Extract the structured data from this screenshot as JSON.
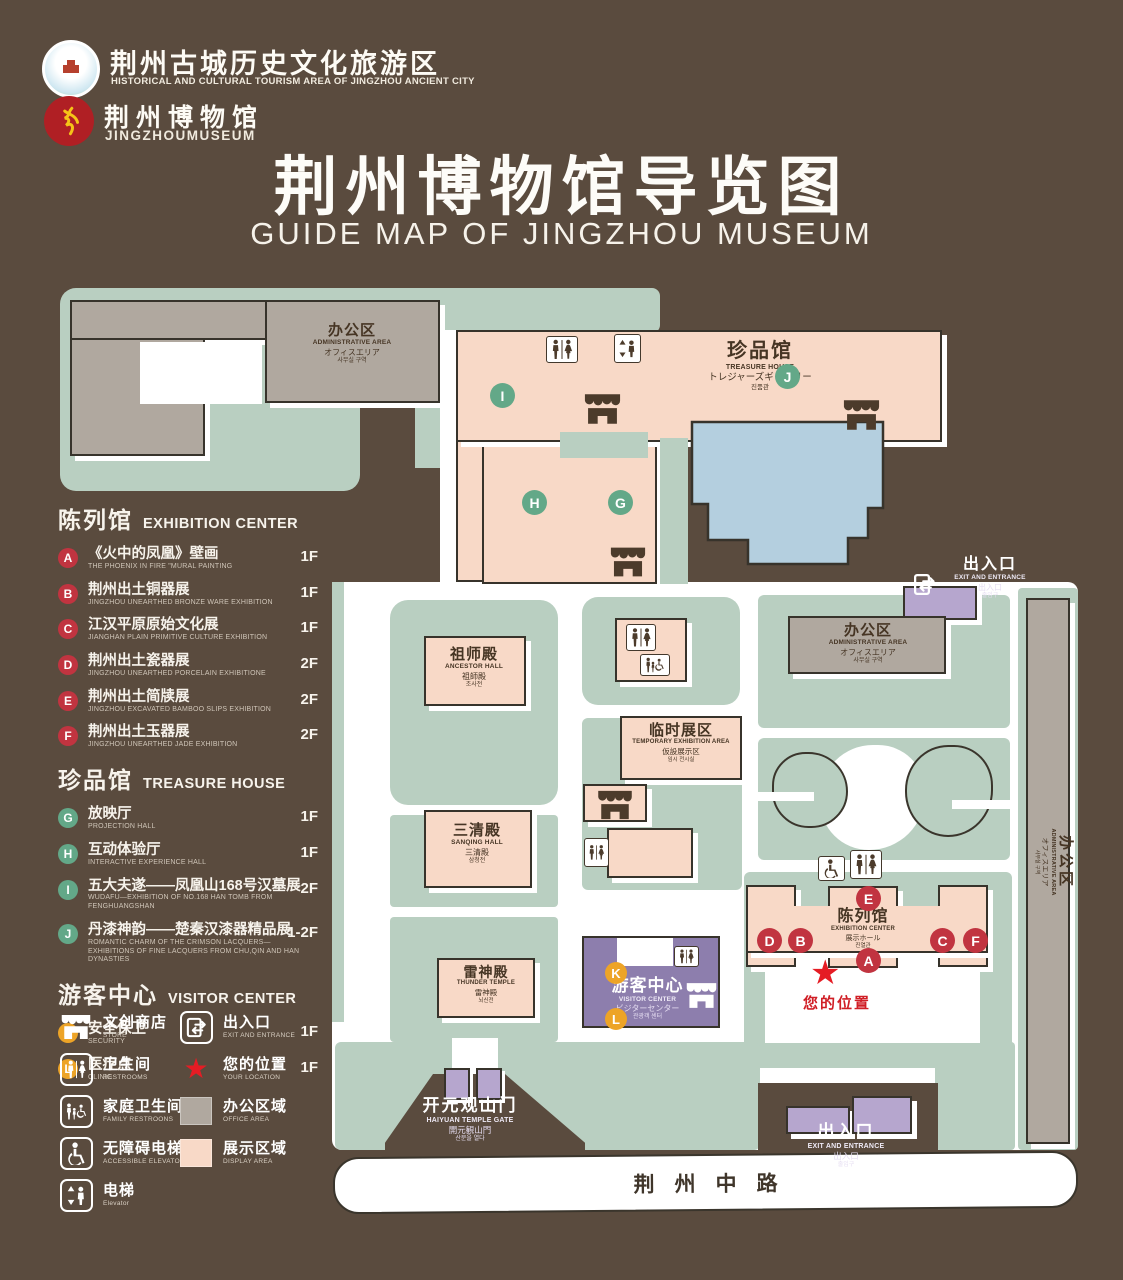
{
  "colors": {
    "background": "#5a4b3e",
    "ground": "#b9cfc1",
    "display_area": "#f8d9c7",
    "office_area": "#b0a89f",
    "water": "#b4cfdf",
    "visitor_purple": "#8d7ead",
    "entrance_purple": "#b6a6ce",
    "marker_red": "#c13440",
    "marker_green": "#63a888",
    "marker_orange": "#eda427",
    "location_red": "#e51c24"
  },
  "header": {
    "org": {
      "cn": "荆州古城历史文化旅游区",
      "en": "HISTORICAL AND CULTURAL TOURISM AREA OF JINGZHOU ANCIENT CITY"
    },
    "museum": {
      "cn": "荆州博物馆",
      "en": "JINGZHOUMUSEUM"
    },
    "title": {
      "cn": "荆州博物馆导览图",
      "en": "GUIDE MAP OF JINGZHOU MUSEUM"
    }
  },
  "legend": {
    "sections": [
      {
        "title_cn": "陈列馆",
        "title_en": "EXHIBITION CENTER",
        "color": "#c13440",
        "items": [
          {
            "id": "A",
            "cn": "《火中的凤凰》壁画",
            "en": "THE PHOENIX IN FIRE \"MURAL PAINTING",
            "floor": "1F"
          },
          {
            "id": "B",
            "cn": "荆州出土铜器展",
            "en": "JINGZHOU UNEARTHED BRONZE WARE EXHIBITION",
            "floor": "1F"
          },
          {
            "id": "C",
            "cn": "江汉平原原始文化展",
            "en": "JIANGHAN PLAIN PRIMITIVE CULTURE EXHIBITION",
            "floor": "1F"
          },
          {
            "id": "D",
            "cn": "荆州出土瓷器展",
            "en": "JINGZHOU UNEARTHED PORCELAIN EXHIBITIONE",
            "floor": "2F"
          },
          {
            "id": "E",
            "cn": "荆州出土简牍展",
            "en": "JINGZHOU EXCAVATED BAMBOO SLIPS EXHIBITION",
            "floor": "2F"
          },
          {
            "id": "F",
            "cn": "荆州出土玉器展",
            "en": "JINGZHOU UNEARTHED JADE EXHIBITION",
            "floor": "2F"
          }
        ]
      },
      {
        "title_cn": "珍品馆",
        "title_en": "TREASURE HOUSE",
        "color": "#63a888",
        "items": [
          {
            "id": "G",
            "cn": "放映厅",
            "en": "PROJECTION HALL",
            "floor": "1F"
          },
          {
            "id": "H",
            "cn": "互动体验厅",
            "en": "INTERACTIVE EXPERIENCE HALL",
            "floor": "1F"
          },
          {
            "id": "I",
            "cn": "五大夫遂——凤凰山168号汉墓展",
            "en": "WUDAFU—EXHIBITION OF NO.168 HAN TOMB FROM FENGHUANGSHAN",
            "floor": "2F"
          },
          {
            "id": "J",
            "cn": "丹漆神韵——楚秦汉漆器精品展",
            "en": "ROMANTIC CHARM OF THE CRIMSON LACQUERS—EXHIBITIONS OF FINE LACQUERS FROM CHU,QIN AND HAN DYNASTIES",
            "floor": "1-2F"
          }
        ]
      },
      {
        "title_cn": "游客中心",
        "title_en": "VISITOR CENTER",
        "color": "#eda427",
        "items": [
          {
            "id": "K",
            "cn": "安全保卫",
            "en": "SECURITY",
            "floor": "1F"
          },
          {
            "id": "L",
            "cn": "医疗点",
            "en": "CLINIC",
            "floor": "1F"
          }
        ]
      }
    ],
    "symbols": [
      {
        "icon": "store",
        "cn": "文创商店",
        "en": "STORE"
      },
      {
        "icon": "exit",
        "cn": "出入口",
        "en": "EXIT AND ENTRANCE"
      },
      {
        "icon": "wc",
        "cn": "卫生间",
        "en": "RESTROOMS"
      },
      {
        "icon": "star",
        "cn": "您的位置",
        "en": "YOUR LOCATION"
      },
      {
        "icon": "family",
        "cn": "家庭卫生间",
        "en": "FAMILY RESTROONS"
      },
      {
        "icon": "office",
        "cn": "办公区域",
        "en": "OFFICE AREA"
      },
      {
        "icon": "accessible",
        "cn": "无障碍电梯",
        "en": "ACCESSIBLE ELEVATOR"
      },
      {
        "icon": "display",
        "cn": "展示区域",
        "en": "DISPLAY AREA"
      },
      {
        "icon": "elevator",
        "cn": "电梯",
        "en": "Elevator"
      }
    ]
  },
  "map": {
    "buildings": {
      "admin_nw": {
        "cn": "办公区",
        "en": "ADMINISTRATIVE AREA",
        "jp": "オフィスエリア",
        "kr": "사무실 구역"
      },
      "treasure": {
        "cn": "珍品馆",
        "en": "TREASURE HOUSE",
        "jp": "トレジャーズギャラリー",
        "kr": "진품관"
      },
      "admin_e": {
        "cn": "办公区",
        "en": "ADMINISTRATIVE AREA",
        "jp": "オフィスエリア",
        "kr": "사무실 구역"
      },
      "admin_strip": {
        "cn": "办公区",
        "en": "ADMINISTRATIVE AREA",
        "jp": "オフィスエリア",
        "kr": "사무실 구역"
      },
      "ancestor": {
        "cn": "祖师殿",
        "en": "ANCESTOR HALL",
        "jp": "祖師殿",
        "kr": "조사전"
      },
      "sanqing": {
        "cn": "三清殿",
        "en": "SANQING HALL",
        "jp": "三清殿",
        "kr": "삼청전"
      },
      "thunder": {
        "cn": "雷神殿",
        "en": "THUNDER TEMPLE",
        "jp": "雷神殿",
        "kr": "뇌신전"
      },
      "temporary": {
        "cn": "临时展区",
        "en": "TEMPORARY EXHIBITION AREA",
        "jp": "仮設展示区",
        "kr": "임시 전시실"
      },
      "visitor": {
        "cn": "游客中心",
        "en": "VISITOR CENTER",
        "jp": "ビジターセンター",
        "kr": "관광객 센터"
      },
      "exhibition": {
        "cn": "陈列馆",
        "en": "EXHIBITION CENTER",
        "jp": "展示ホール",
        "kr": "진열관"
      },
      "gate": {
        "cn": "开元观山门",
        "en": "HAIYUAN TEMPLE GATE",
        "jp": "開元観山門",
        "kr": "산문을 열다"
      },
      "exit": {
        "cn": "出入口",
        "en": "EXIT AND ENTRANCE",
        "jp": "出入口",
        "kr": "출입구"
      }
    },
    "road": "荆州中路",
    "your_location": "您的位置",
    "markers": [
      "A",
      "B",
      "C",
      "D",
      "E",
      "F",
      "G",
      "H",
      "I",
      "J",
      "K",
      "L"
    ]
  }
}
